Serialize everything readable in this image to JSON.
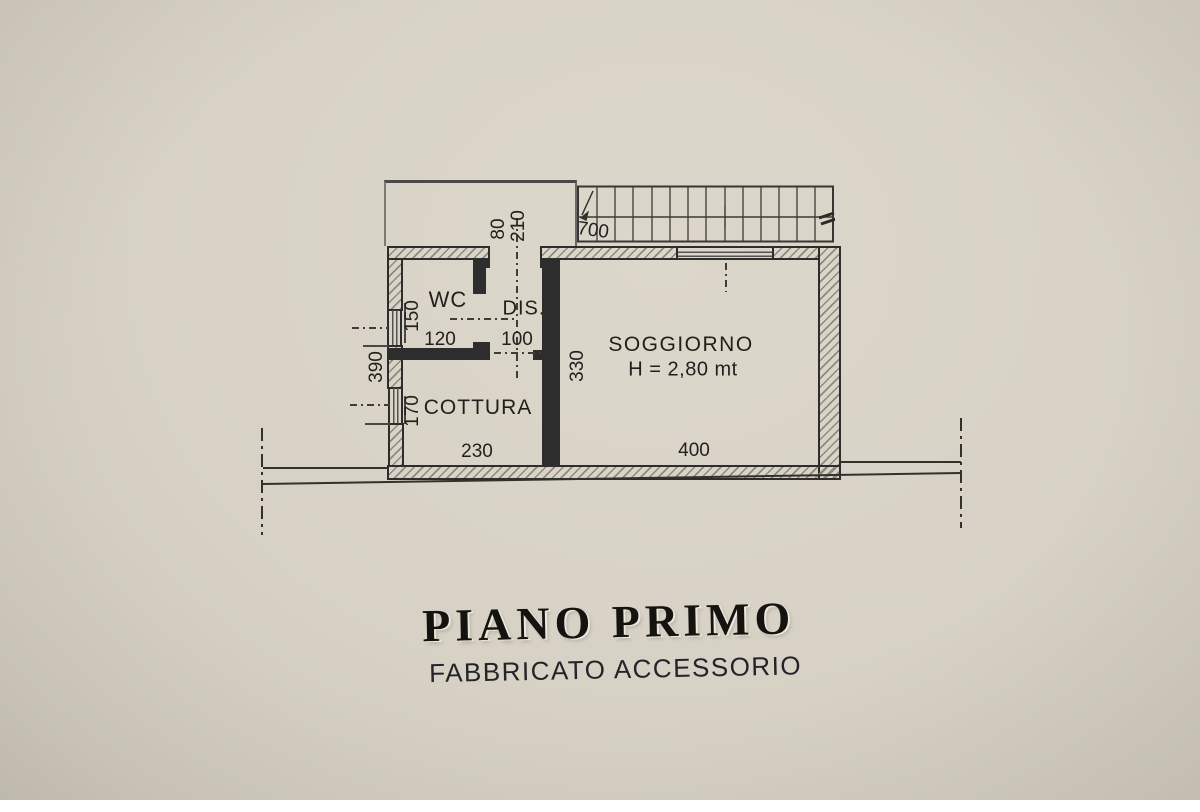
{
  "title": {
    "main": "PIANO PRIMO",
    "subtitle": "FABBRICATO ACCESSORIO"
  },
  "plan": {
    "rooms": {
      "wc": {
        "label": "WC",
        "width_dim": "120",
        "depth_dim": "150"
      },
      "dis": {
        "label": "DIS.",
        "width_dim": "100"
      },
      "cottura": {
        "label": "COTTURA",
        "width_dim": "230",
        "depth_dim": "170"
      },
      "soggiorno": {
        "label": "SOGGIORNO",
        "height_note": "H = 2,80 mt",
        "width_dim": "400",
        "depth_dim": "330"
      }
    },
    "dims": {
      "balcony_door": "80",
      "balcony_depth": "210",
      "stairs_length": "700",
      "left_side": "390"
    }
  },
  "colors": {
    "paper": "#d8d3c6",
    "ink": "#2d2d2d",
    "hatch": "#8f897b"
  }
}
